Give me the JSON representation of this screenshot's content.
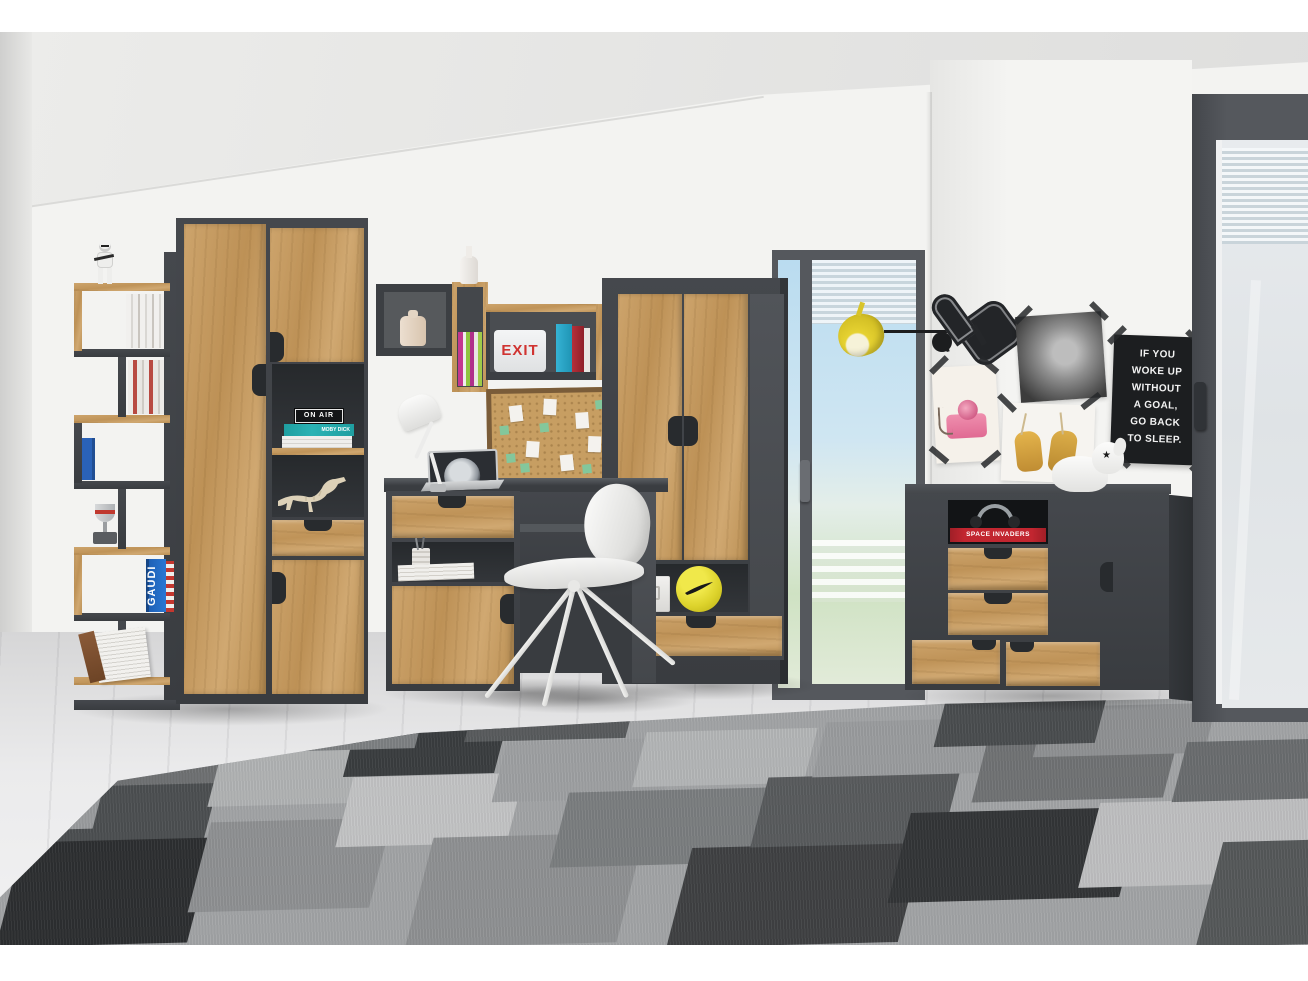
{
  "scene": {
    "description": "3D showroom render of a teen room furniture set in graphite grey and golden oak",
    "room": {
      "furniture": [
        "ladder-bookshelf",
        "tall-two-door-cabinet",
        "wall-cube-shelves",
        "desk-with-cabinet",
        "wardrobe",
        "sideboard"
      ],
      "decor_objects": [
        "stormtrooper-figurine",
        "trophy",
        "dinosaur-skeleton-model",
        "books",
        "white-desk-lamp",
        "laptop",
        "cork-pinboard",
        "white-office-chair",
        "nike-football",
        "white-storage-box",
        "yellow-wall-lamp",
        "foam-finger",
        "pink-camera-photo",
        "portrait-photo",
        "yellow-shoes-photo",
        "quote-poster",
        "headphones",
        "white-dog-figurine",
        "geometric-grey-rug",
        "floor-to-ceiling-windows"
      ]
    },
    "labels": {
      "exit": "EXIT",
      "on_air": "ON AIR",
      "moby_dick": "MOBY DICK",
      "gaudi": "GAUDI",
      "space_invaders": "SPACE INVADERS"
    },
    "poster": {
      "lines": [
        "IF YOU",
        "WOKE UP",
        "WITHOUT",
        "A GOAL,",
        "GO BACK",
        "TO SLEEP."
      ]
    },
    "colors": {
      "graphite": "#3E4145",
      "oak": "#C59E63",
      "wall": "#F2F2F0",
      "floor": "#E3E3E4",
      "sky": "#BCDCEF",
      "accent_yellow": "#E2CF2F",
      "poster_black": "#1C1E20",
      "exit_red": "#D03431",
      "book_teal": "#2AB3B5",
      "book_blue": "#2A62B8",
      "book_red": "#B8242C",
      "rug_greys": [
        "#C6C7C8",
        "#B1B3B4",
        "#8F9193",
        "#6F7173",
        "#505254",
        "#3A3D3F",
        "#2C2E30"
      ]
    }
  }
}
